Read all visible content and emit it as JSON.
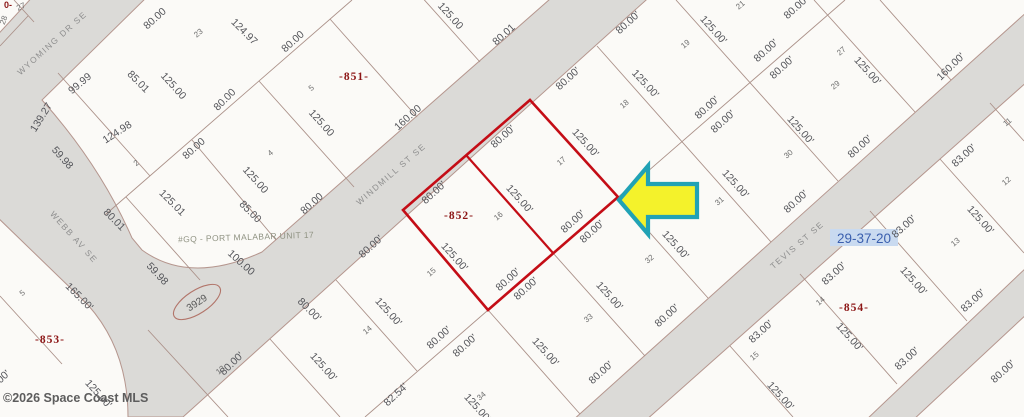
{
  "map": {
    "watermark": "©2026 Space Coast MLS",
    "section_label": "29-37-20",
    "plat_note": "#GQ - PORT MALABAR UNIT 17",
    "address_bubble": "3929",
    "corner_fragment": "0-",
    "colors": {
      "parcel_outline": "#c40d16",
      "arrow_fill": "#f4f22b",
      "arrow_border": "#21a2b5",
      "road_fill": "#dbdad7",
      "road_border": "#b5968e",
      "lot_line": "#ab9189",
      "section_bg": "#c9daf0"
    },
    "streets": [
      {
        "name": "WYOMING DR SE",
        "x": 52,
        "y": 43,
        "r": -42
      },
      {
        "name": "WINDMILL ST SE",
        "x": 391,
        "y": 174,
        "r": -41
      },
      {
        "name": "WEBB AV SE",
        "x": 74,
        "y": 237,
        "r": 48
      },
      {
        "name": "TEVIS ST SE",
        "x": 797,
        "y": 245,
        "r": -41
      }
    ],
    "blocks": [
      {
        "label": "-851-",
        "x": 354,
        "y": 80
      },
      {
        "label": "-852-",
        "x": 459,
        "y": 219
      },
      {
        "label": "-853-",
        "x": 50,
        "y": 343
      },
      {
        "label": "-854-",
        "x": 854,
        "y": 311
      }
    ],
    "lot_numbers": [
      {
        "n": "27",
        "x": 22,
        "y": 9,
        "r": -25
      },
      {
        "n": "28",
        "x": 6,
        "y": 21,
        "r": -70
      },
      {
        "n": "23",
        "x": 200,
        "y": 35,
        "r": -40
      },
      {
        "n": "2",
        "x": 138,
        "y": 165,
        "r": -40
      },
      {
        "n": "4",
        "x": 272,
        "y": 155,
        "r": -40
      },
      {
        "n": "5",
        "x": 313,
        "y": 90,
        "r": -40
      },
      {
        "n": "5",
        "x": 24,
        "y": 295,
        "r": -40
      },
      {
        "n": "18",
        "x": 626,
        "y": 106,
        "r": -40
      },
      {
        "n": "17",
        "x": 563,
        "y": 163,
        "r": -40
      },
      {
        "n": "16",
        "x": 500,
        "y": 218,
        "r": -40
      },
      {
        "n": "19",
        "x": 687,
        "y": 46,
        "r": -40
      },
      {
        "n": "21",
        "x": 742,
        "y": 7,
        "r": -40
      },
      {
        "n": "27",
        "x": 843,
        "y": 53,
        "r": -40
      },
      {
        "n": "29",
        "x": 837,
        "y": 87,
        "r": -40
      },
      {
        "n": "30",
        "x": 790,
        "y": 156,
        "r": -40
      },
      {
        "n": "31",
        "x": 721,
        "y": 203,
        "r": -40
      },
      {
        "n": "32",
        "x": 651,
        "y": 261,
        "r": -40
      },
      {
        "n": "33",
        "x": 590,
        "y": 320,
        "r": -40
      },
      {
        "n": "34",
        "x": 483,
        "y": 398,
        "r": -40
      },
      {
        "n": "15",
        "x": 433,
        "y": 274,
        "r": -40
      },
      {
        "n": "14",
        "x": 369,
        "y": 332,
        "r": -40
      },
      {
        "n": "11",
        "x": 1009,
        "y": 124,
        "r": -40
      },
      {
        "n": "12",
        "x": 1008,
        "y": 183,
        "r": -40
      },
      {
        "n": "13",
        "x": 957,
        "y": 244,
        "r": -40
      },
      {
        "n": "14",
        "x": 822,
        "y": 303,
        "r": -40
      },
      {
        "n": "15",
        "x": 756,
        "y": 358,
        "r": -40
      },
      {
        "n": "13",
        "x": 222,
        "y": 372,
        "r": -40
      }
    ],
    "dimensions": [
      {
        "t": "80.00",
        "x": 157,
        "y": 21,
        "r": -42
      },
      {
        "t": "124.97",
        "x": 242,
        "y": 34,
        "r": 45
      },
      {
        "t": "125.00",
        "x": 448,
        "y": 18,
        "r": 48
      },
      {
        "t": "80.01",
        "x": 506,
        "y": 37,
        "r": -42
      },
      {
        "t": "80.00",
        "x": 295,
        "y": 44,
        "r": -42
      },
      {
        "t": "80.00",
        "x": 227,
        "y": 102,
        "r": -45
      },
      {
        "t": "125.00",
        "x": 171,
        "y": 88,
        "r": 48
      },
      {
        "t": "85.01",
        "x": 136,
        "y": 84,
        "r": 45
      },
      {
        "t": "99.99",
        "x": 82,
        "y": 86,
        "r": -40
      },
      {
        "t": "139.27",
        "x": 44,
        "y": 119,
        "r": -58
      },
      {
        "t": "59.98",
        "x": 60,
        "y": 160,
        "r": 48
      },
      {
        "t": "124.98",
        "x": 119,
        "y": 135,
        "r": -33
      },
      {
        "t": "80.00",
        "x": 196,
        "y": 151,
        "r": -42
      },
      {
        "t": "125.00",
        "x": 319,
        "y": 125,
        "r": 48
      },
      {
        "t": "125.00",
        "x": 253,
        "y": 182,
        "r": 48
      },
      {
        "t": "160.00",
        "x": 410,
        "y": 120,
        "r": -42
      },
      {
        "t": "80.00",
        "x": 314,
        "y": 206,
        "r": -42
      },
      {
        "t": "125.01",
        "x": 170,
        "y": 205,
        "r": 45
      },
      {
        "t": "85.00",
        "x": 248,
        "y": 214,
        "r": 45
      },
      {
        "t": "80.01",
        "x": 112,
        "y": 222,
        "r": 45
      },
      {
        "t": "100.00",
        "x": 239,
        "y": 265,
        "r": 42
      },
      {
        "t": "59.98",
        "x": 155,
        "y": 276,
        "r": 47
      },
      {
        "t": "165.00'",
        "x": 77,
        "y": 299,
        "r": 45
      },
      {
        "t": "125.00'",
        "x": 96,
        "y": 396,
        "r": 48
      },
      {
        "t": "80.00'",
        "x": 570,
        "y": 81,
        "r": -42
      },
      {
        "t": "125.00'",
        "x": 643,
        "y": 86,
        "r": 47
      },
      {
        "t": "80.00'",
        "x": 630,
        "y": 25,
        "r": -42
      },
      {
        "t": "125.00'",
        "x": 711,
        "y": 32,
        "r": 48
      },
      {
        "t": "80.00'",
        "x": 768,
        "y": 53,
        "r": -42
      },
      {
        "t": "80.00'",
        "x": 784,
        "y": 70,
        "r": -42
      },
      {
        "t": "80.00'",
        "x": 798,
        "y": 10,
        "r": -42
      },
      {
        "t": "125.00'",
        "x": 865,
        "y": 73,
        "r": 48
      },
      {
        "t": "160.00'",
        "x": 953,
        "y": 69,
        "r": -44
      },
      {
        "t": "125.00'",
        "x": 798,
        "y": 132,
        "r": 48
      },
      {
        "t": "80.00'",
        "x": 862,
        "y": 149,
        "r": -42
      },
      {
        "t": "83.00'",
        "x": 966,
        "y": 158,
        "r": -42
      },
      {
        "t": "80.00'",
        "x": 709,
        "y": 110,
        "r": -42
      },
      {
        "t": "80.00'",
        "x": 725,
        "y": 124,
        "r": -42
      },
      {
        "t": "80.00'",
        "x": 436,
        "y": 195,
        "r": -42
      },
      {
        "t": "80.00'",
        "x": 505,
        "y": 139,
        "r": -42
      },
      {
        "t": "125.00'",
        "x": 583,
        "y": 145,
        "r": 48
      },
      {
        "t": "125.00'",
        "x": 517,
        "y": 201,
        "r": 48
      },
      {
        "t": "125.00'",
        "x": 452,
        "y": 259,
        "r": 48
      },
      {
        "t": "80.00'",
        "x": 575,
        "y": 224,
        "r": -42
      },
      {
        "t": "80.00'",
        "x": 594,
        "y": 234,
        "r": -42
      },
      {
        "t": "80.00'",
        "x": 510,
        "y": 282,
        "r": -42
      },
      {
        "t": "80.00'",
        "x": 528,
        "y": 291,
        "r": -42
      },
      {
        "t": "80.00'",
        "x": 373,
        "y": 249,
        "r": -42
      },
      {
        "t": "125.00'",
        "x": 386,
        "y": 314,
        "r": 48
      },
      {
        "t": "125.00'",
        "x": 321,
        "y": 369,
        "r": 48
      },
      {
        "t": "80.00'",
        "x": 798,
        "y": 204,
        "r": -42
      },
      {
        "t": "125.00'",
        "x": 733,
        "y": 186,
        "r": 48
      },
      {
        "t": "125.00'",
        "x": 673,
        "y": 247,
        "r": 48
      },
      {
        "t": "125.00'",
        "x": 607,
        "y": 298,
        "r": 48
      },
      {
        "t": "125.00'",
        "x": 543,
        "y": 354,
        "r": 48
      },
      {
        "t": "80.00'",
        "x": 669,
        "y": 318,
        "r": -42
      },
      {
        "t": "80.00'",
        "x": 441,
        "y": 340,
        "r": -42
      },
      {
        "t": "80.00'",
        "x": 467,
        "y": 348,
        "r": -42
      },
      {
        "t": "80.00'",
        "x": 603,
        "y": 375,
        "r": -42
      },
      {
        "t": "82.54'",
        "x": 398,
        "y": 397,
        "r": -43
      },
      {
        "t": "125.00'",
        "x": 475,
        "y": 410,
        "r": 48
      },
      {
        "t": "80.00'",
        "x": 234,
        "y": 366,
        "r": -44
      },
      {
        "t": "80.00'",
        "x": 307,
        "y": 312,
        "r": 45
      },
      {
        "t": "83.00'",
        "x": 906,
        "y": 229,
        "r": -42
      },
      {
        "t": "125.00'",
        "x": 978,
        "y": 222,
        "r": 48
      },
      {
        "t": "83.00'",
        "x": 836,
        "y": 276,
        "r": -42
      },
      {
        "t": "125.00'",
        "x": 911,
        "y": 283,
        "r": 48
      },
      {
        "t": "83.00'",
        "x": 763,
        "y": 334,
        "r": -42
      },
      {
        "t": "125.00'",
        "x": 847,
        "y": 339,
        "r": 48
      },
      {
        "t": "83.00'",
        "x": 975,
        "y": 303,
        "r": -42
      },
      {
        "t": "83.00'",
        "x": 909,
        "y": 361,
        "r": -42
      },
      {
        "t": "125.00'",
        "x": 778,
        "y": 398,
        "r": 48
      },
      {
        "t": "80.00'",
        "x": 1005,
        "y": 374,
        "r": -42
      },
      {
        "t": "80.00'",
        "x": 0,
        "y": 384,
        "r": -42
      }
    ]
  }
}
